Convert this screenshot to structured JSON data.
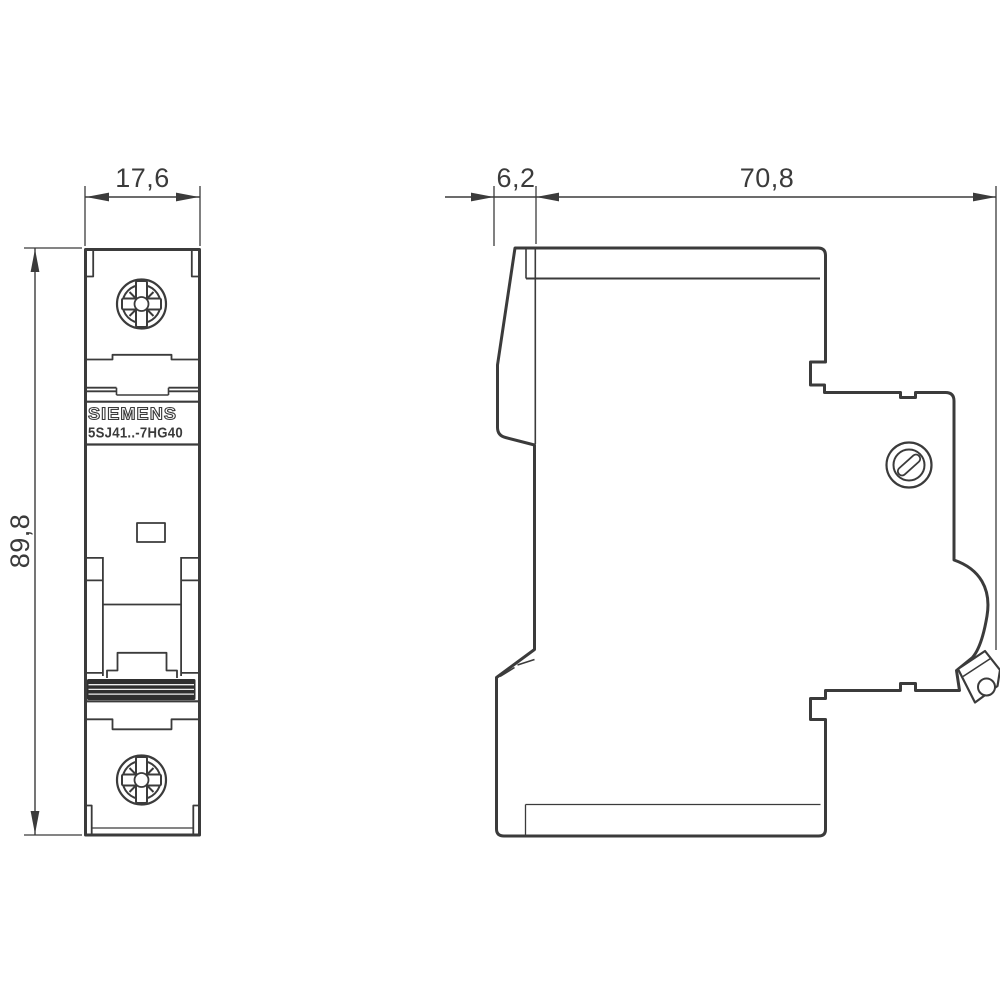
{
  "theme": {
    "line": "#3b3b3b",
    "bg": "#ffffff",
    "grip": "#2f2f2f"
  },
  "front_view": {
    "brand": "SIEMENS",
    "product_code": "5SJ41..-7HG40",
    "width_dim": "17,6",
    "height_dim": "89,8"
  },
  "side_view": {
    "lever_depth_dim": "6,2",
    "total_depth_dim": "70,8"
  }
}
